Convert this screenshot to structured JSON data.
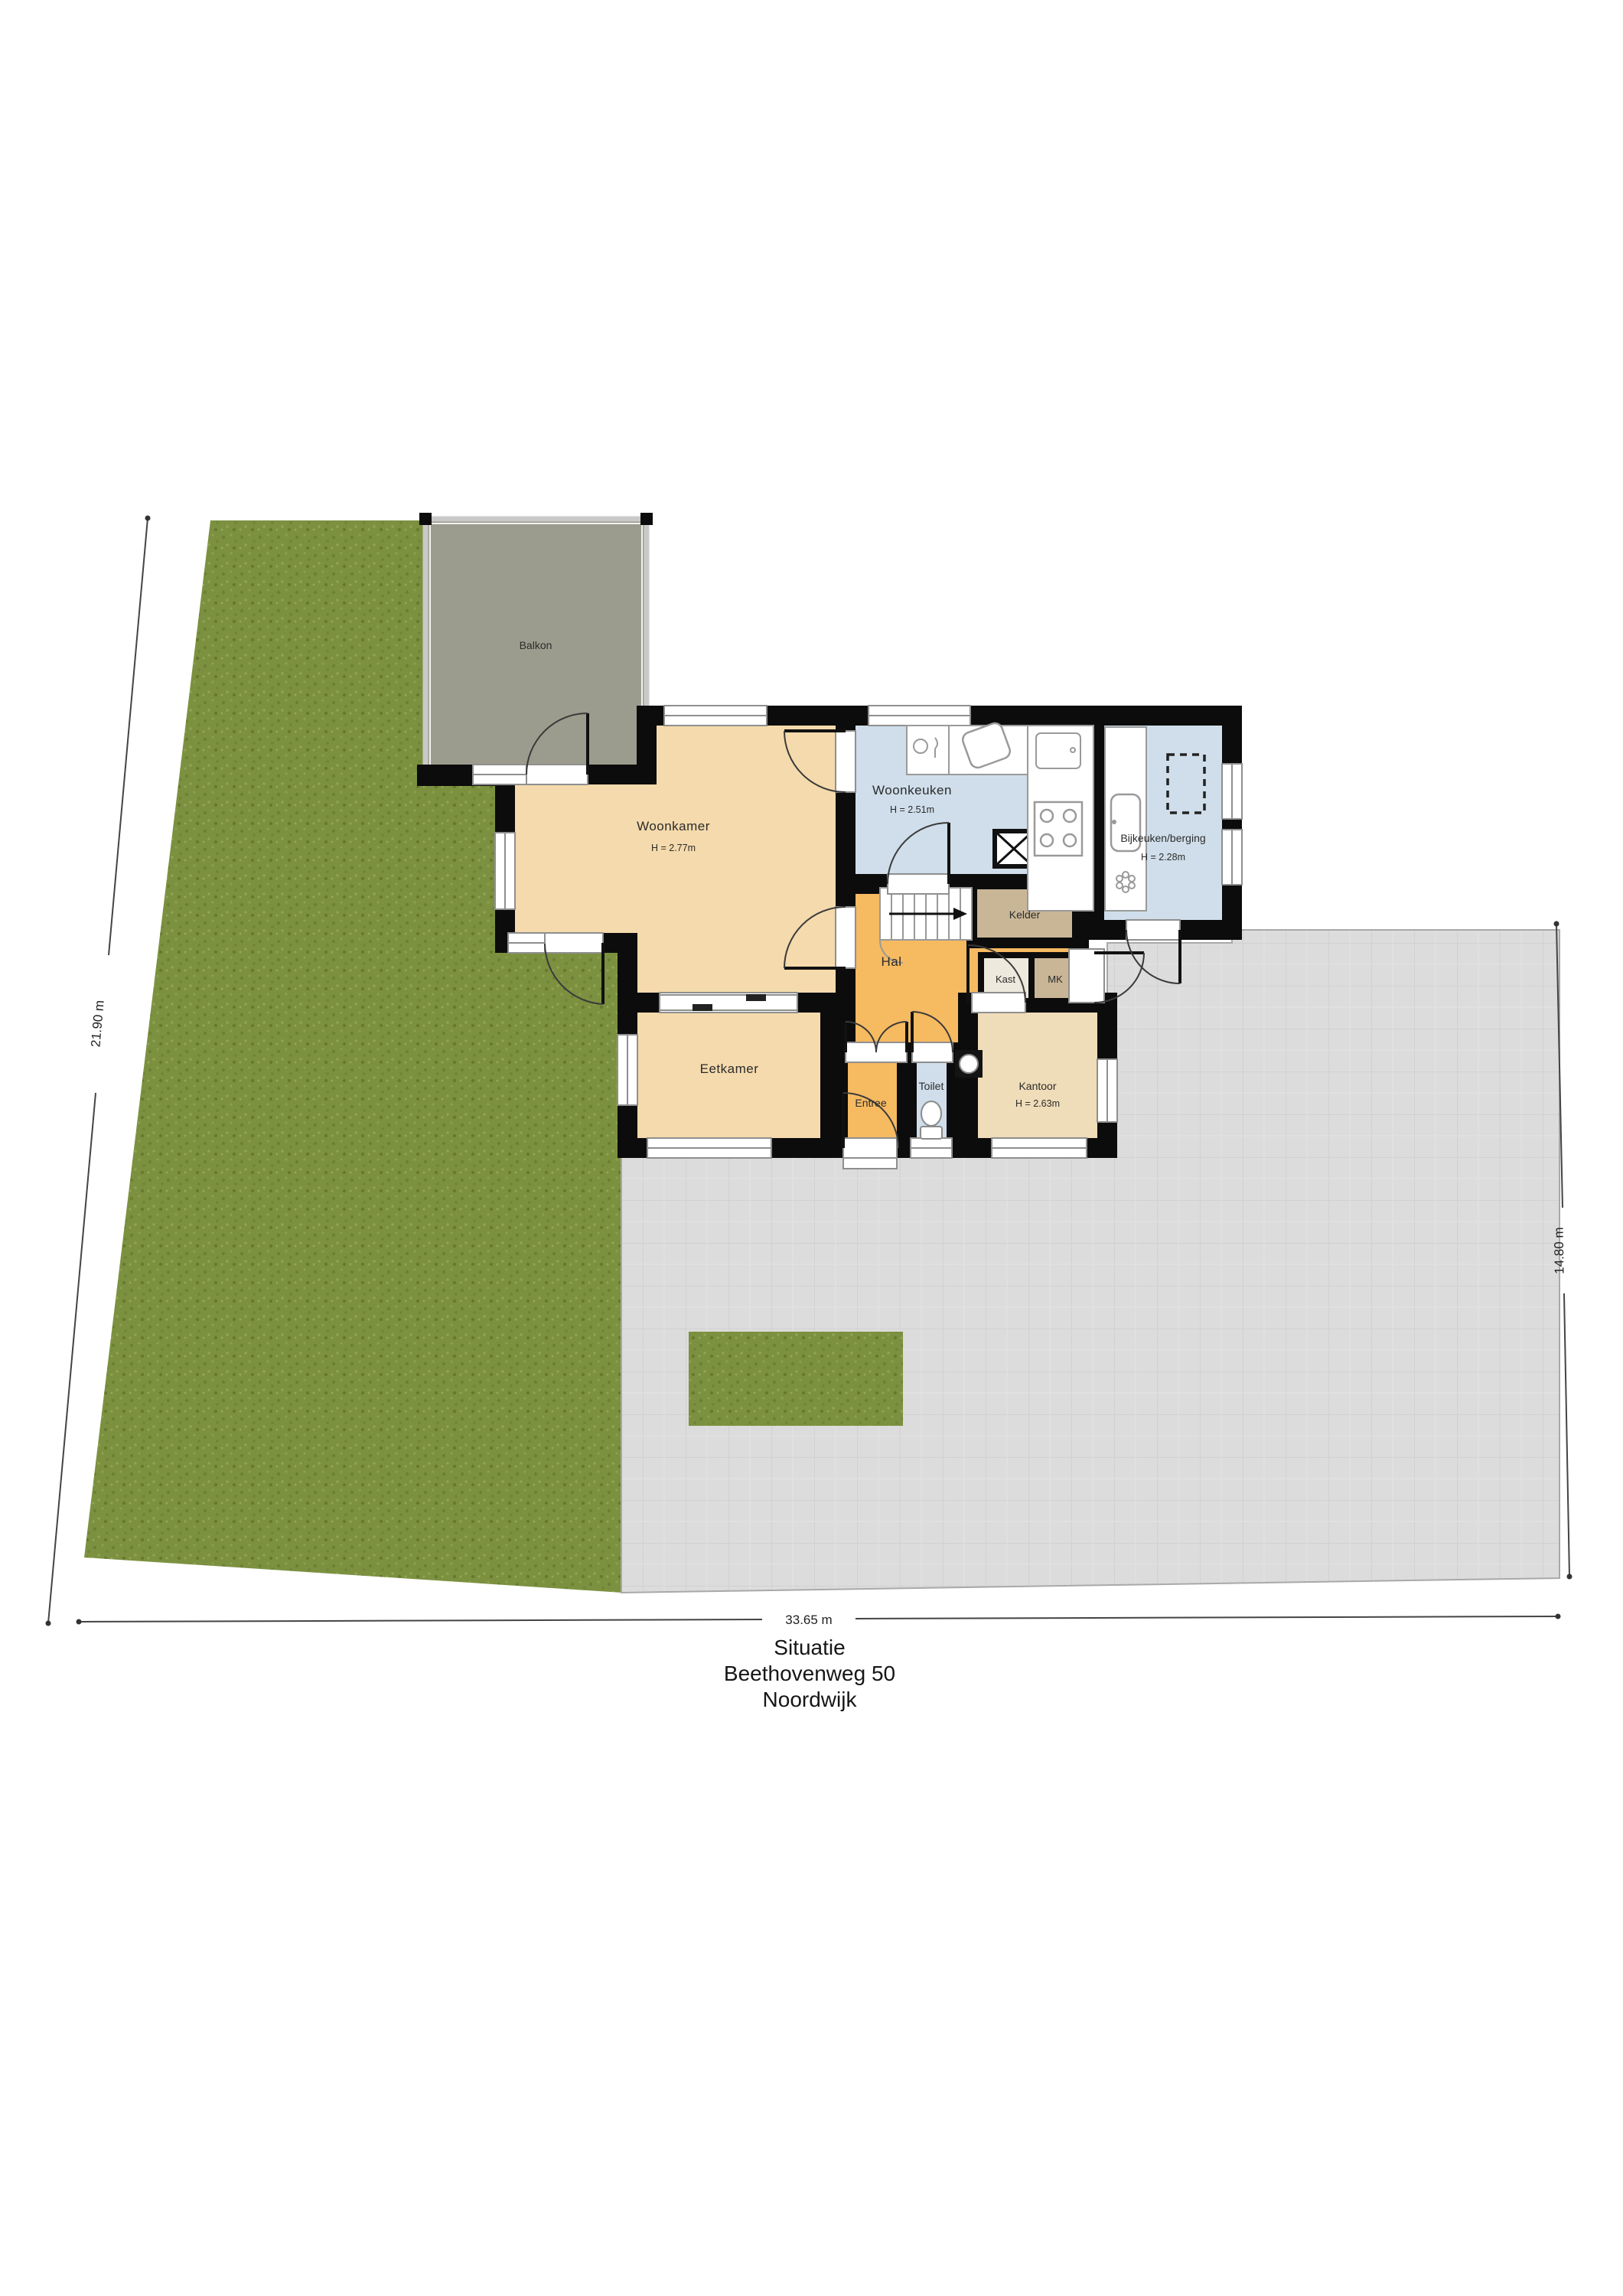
{
  "site": {
    "dimensions": {
      "left": "21.90 m",
      "right": "14.80 m",
      "bottom": "33.65 m"
    }
  },
  "rooms": {
    "balkon": {
      "label": "Balkon"
    },
    "woonkamer": {
      "label": "Woonkamer",
      "height": "H = 2.77m"
    },
    "woonkeuken": {
      "label": "Woonkeuken",
      "height": "H = 2.51m"
    },
    "bijkeuken": {
      "label": "Bijkeuken/berging",
      "height": "H = 2.28m"
    },
    "kelder": {
      "label": "Kelder"
    },
    "hal": {
      "label": "Hal"
    },
    "kast": {
      "label": "Kast"
    },
    "mk": {
      "label": "MK"
    },
    "eetkamer": {
      "label": "Eetkamer"
    },
    "entree": {
      "label": "Entree"
    },
    "toilet": {
      "label": "Toilet"
    },
    "kantoor": {
      "label": "Kantoor",
      "height": "H = 2.63m"
    }
  },
  "title_block": {
    "line1": "Situatie",
    "line2": "Beethovenweg 50",
    "line3": "Noordwijk"
  },
  "colors": {
    "garden": "#7C9140",
    "paving": "#DCDCDC",
    "balcony": "#9C9C8E",
    "room_tan": "#F4DAAC",
    "room_orange": "#F6BA61",
    "room_blue": "#CFDEEA",
    "room_brown": "#C9B697",
    "office_tan": "#EFDCB8",
    "wall": "#0C0C0C"
  }
}
